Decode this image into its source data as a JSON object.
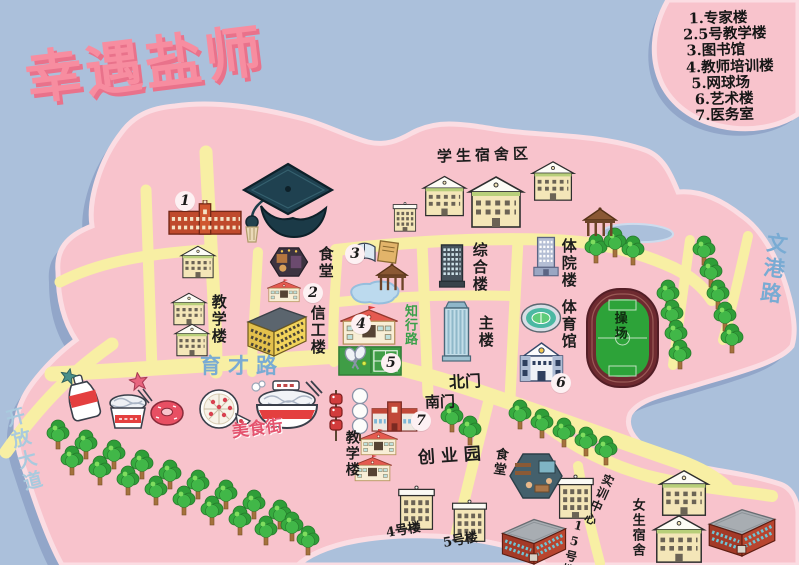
{
  "title": "幸遇盐师",
  "legend": [
    "1.专家楼",
    "2.5号教学楼",
    "3.图书馆",
    "4.教师培训楼",
    "5.网球场",
    "6.艺术楼",
    "7.医务室"
  ],
  "roads": {
    "kaifang_avenue": "开放大道",
    "wengang_road": "文港路",
    "yucai_road": "育才路",
    "zhixing_road": "知行路"
  },
  "gates": {
    "north": "北门",
    "south": "南门"
  },
  "areas": {
    "student_dorm_area": "学生宿舍区",
    "canteen_top": "食堂",
    "teaching_west": "教学楼",
    "xingong_building": "信工楼",
    "zonghe_building": "综合楼",
    "tiyuan_building": "体院楼",
    "main_building": "主楼",
    "gymnasium": "体育馆",
    "playground": "操场",
    "food_street": "美食街",
    "teaching_south": "教学楼",
    "chuangye_park": "创业园",
    "canteen_south": "食堂",
    "shixun_center": "实训中心",
    "building_4": "4号楼",
    "building_5": "5号楼",
    "building_15": "15号楼",
    "girls_dorm": "女生宿舍"
  },
  "markers": [
    "1",
    "2",
    "3",
    "4",
    "5",
    "6",
    "7"
  ],
  "icons": [
    "graduation-cap",
    "tree",
    "pavilion",
    "stadium",
    "running-track",
    "tennis-court",
    "pond",
    "open-books",
    "noodle-bowl",
    "cup-noodles",
    "donut",
    "pizza",
    "bbq-skewer",
    "dango-skewer",
    "soda-bottle",
    "star",
    "canteen-scene",
    "cafe-scene"
  ],
  "colors": {
    "water": "#abc0db",
    "island": "#f8c3cc",
    "island_rim": "#fbdde3",
    "island_shadow": "#8fa3c6",
    "road": "#f8efa4",
    "title_pink": "#f78da0",
    "title_shadow": "#e9728b",
    "road_label_blue": "#79abd3",
    "kaifang_blue": "#a9cade",
    "zhixing_green": "#3aa04a",
    "food_street_pink": "#e4536e",
    "track_green": "#2da339",
    "track_ring": "#6e2a30",
    "label_ink": "#1c1c1c"
  }
}
